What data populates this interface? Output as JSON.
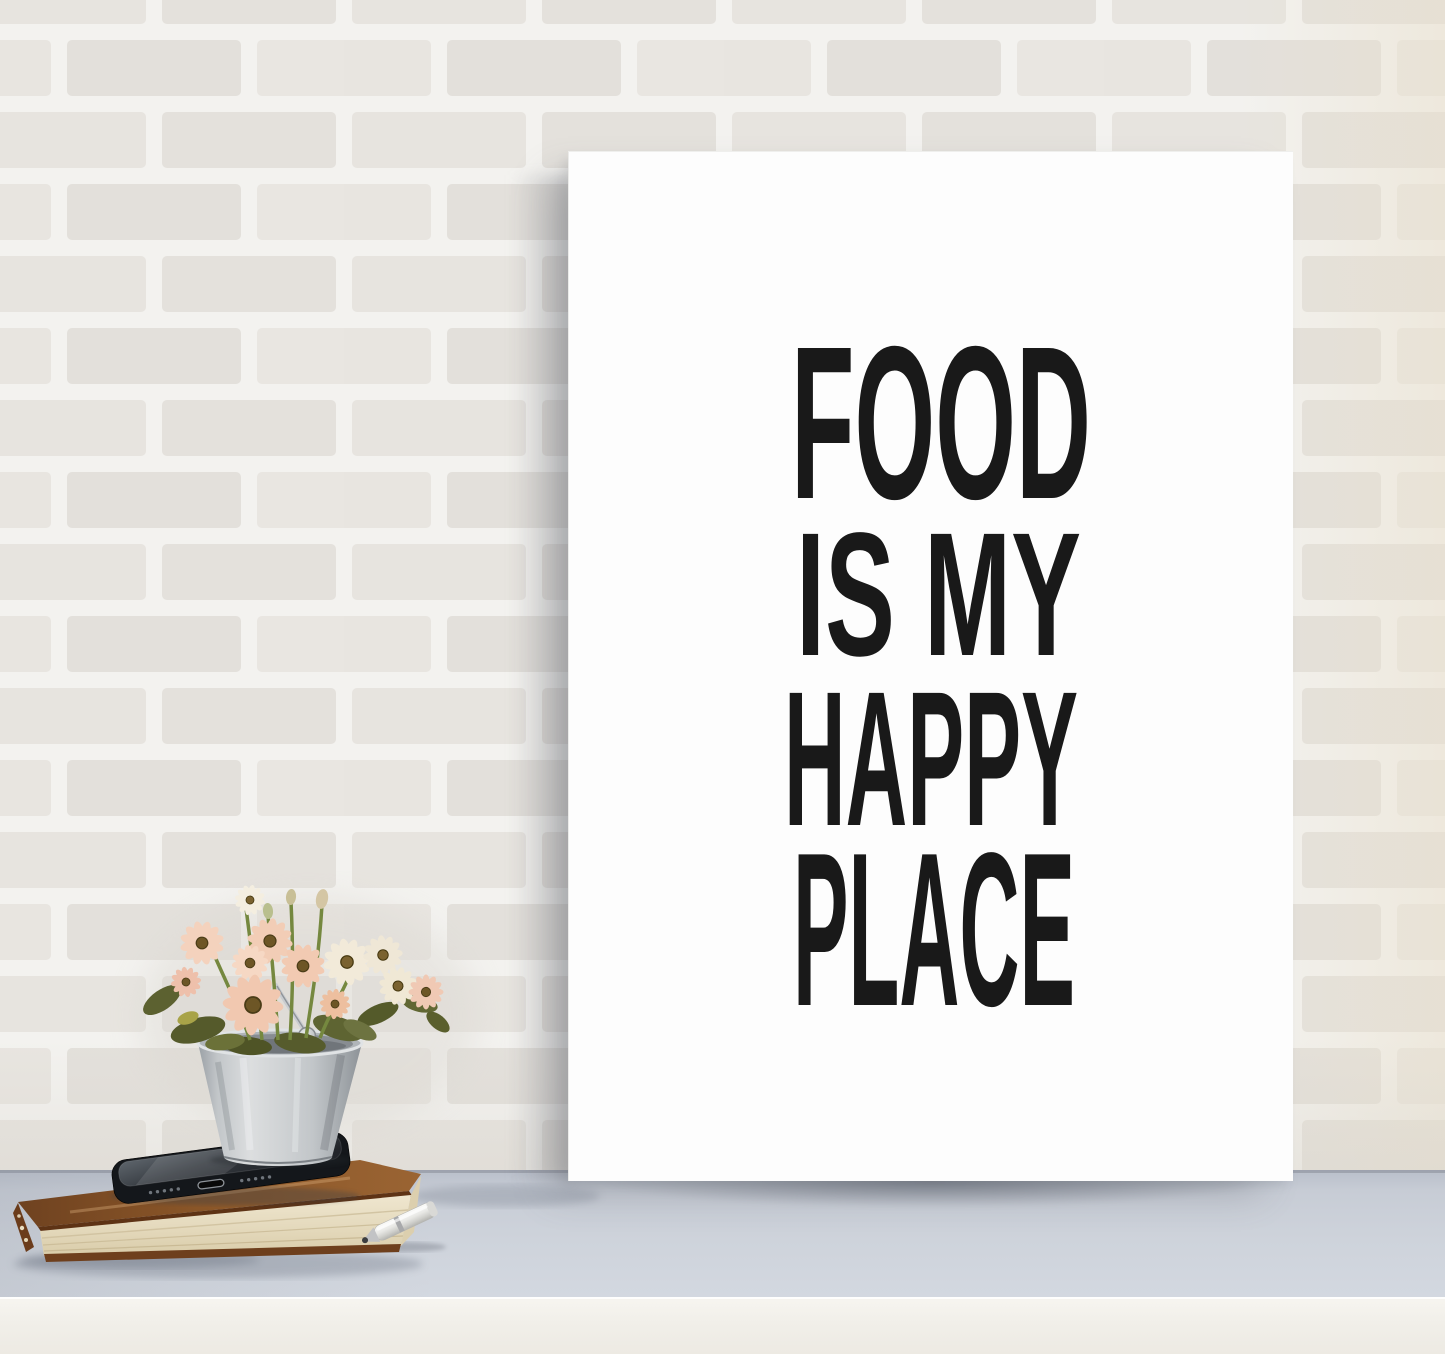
{
  "image": {
    "kind": "product-photo",
    "subject": "black and white typography art print leaning on a table against a white brick wall"
  },
  "poster": {
    "lines": [
      "FOOD",
      "IS MY",
      "HAPPY",
      "PLACE"
    ],
    "text_color": "#191919",
    "paper_color": "#fdfdfd"
  },
  "scene": {
    "wall": {
      "type": "painted-white-brick",
      "mortar_color": "#f3f2ef",
      "brick_color": "#e6e3de"
    },
    "table": {
      "surface_color": "#cbd0d9",
      "front_edge_color": "#f1efe9"
    },
    "props": {
      "bucket": {
        "material": "galvanized-metal",
        "color": "#c6cacd"
      },
      "flowers": {
        "kind": "daisies",
        "petal_colors": [
          "#f1c8b0",
          "#f2ead9"
        ],
        "center_color": "#6d5626",
        "leaf_color": "#575c2c",
        "stem_color": "#75883f"
      },
      "phone": {
        "color": "#14171b"
      },
      "book": {
        "cover_color": "#7d4b24",
        "pages_color": "#e6dcc2"
      },
      "pen": {
        "body_color": "#e9e9e6",
        "tip_color": "#c2c3c5"
      }
    }
  }
}
